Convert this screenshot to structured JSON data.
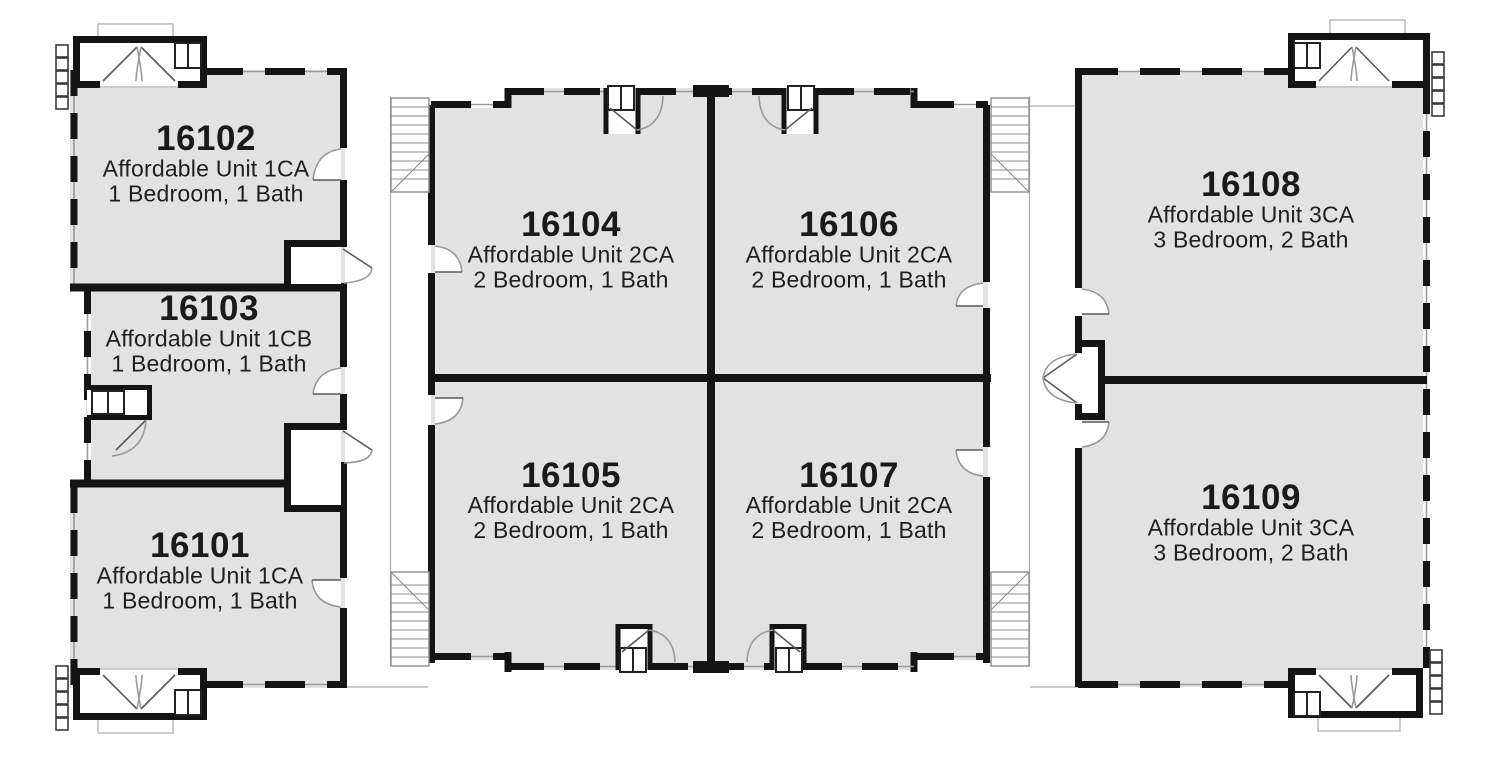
{
  "plan": {
    "kind": "site-floor-plan",
    "colors": {
      "unit_fill": "#e2e2e2",
      "wall": "#141414",
      "detail_line": "#9a9a9a",
      "text": "#1a1a1a",
      "background": "#ffffff"
    },
    "buildings": [
      {
        "id": "building-left",
        "units": [
          {
            "number": "16102",
            "type": "Affordable Unit 1CA",
            "layout": "1 Bedroom, 1 Bath"
          },
          {
            "number": "16103",
            "type": "Affordable Unit 1CB",
            "layout": "1 Bedroom, 1 Bath"
          },
          {
            "number": "16101",
            "type": "Affordable Unit 1CA",
            "layout": "1 Bedroom, 1 Bath"
          }
        ]
      },
      {
        "id": "building-middle",
        "units": [
          {
            "number": "16104",
            "type": "Affordable Unit 2CA",
            "layout": "2 Bedroom, 1 Bath"
          },
          {
            "number": "16106",
            "type": "Affordable Unit 2CA",
            "layout": "2 Bedroom, 1 Bath"
          },
          {
            "number": "16105",
            "type": "Affordable Unit 2CA",
            "layout": "2 Bedroom, 1 Bath"
          },
          {
            "number": "16107",
            "type": "Affordable Unit 2CA",
            "layout": "2 Bedroom, 1 Bath"
          }
        ]
      },
      {
        "id": "building-right",
        "units": [
          {
            "number": "16108",
            "type": "Affordable Unit 3CA",
            "layout": "3 Bedroom, 2 Bath"
          },
          {
            "number": "16109",
            "type": "Affordable Unit 3CA",
            "layout": "3 Bedroom, 2 Bath"
          }
        ]
      }
    ]
  }
}
